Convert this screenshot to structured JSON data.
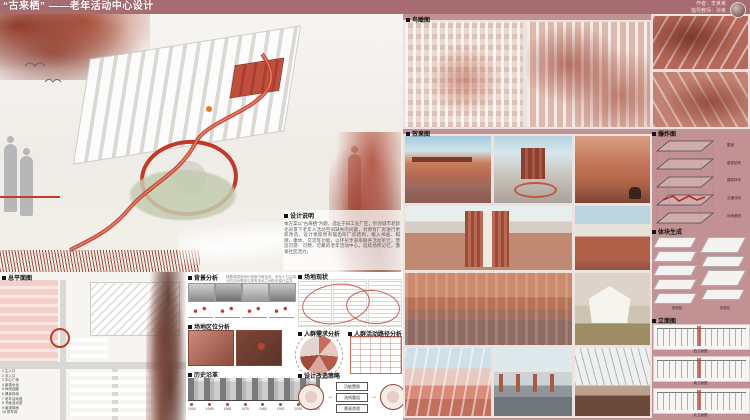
{
  "banner": {
    "title": "“古来栖” ——老年活动中心设计",
    "credits": {
      "author": "作者：李某某",
      "advisor": "指导教师：孙某"
    }
  },
  "design_note": {
    "heading": "设计说明",
    "body": "本方案以“古来栖”为题，选址于旧工业厂区，针对城市老龄化背景下老年人活动空间缺失的问题，对原有厂房进行更新改造。设计保留原有锯齿形厂房结构，植入书画、棋牌、康体、交流等功能，以环形步道串联各活动单元，营造可游、可憩、可聚的老年活动中心，延续场所记忆，激发社区活力。"
  },
  "site_plan": {
    "label": "总平面图",
    "legend": [
      "1 主入口",
      "2 次入口",
      "3 中心广场",
      "4 景观水池",
      "5 休闲连廊",
      "6 健身场地",
      "7 老年活动馆",
      "8 书画活动室",
      "9 景观绿地",
      "10 停车场"
    ]
  },
  "analysis": {
    "background": {
      "label": "背景分析",
      "note": "随着我国老龄化程度不断加深，老年人日益增长的活动需求与现有场地之间的矛盾日益突出。"
    },
    "location": {
      "label": "场地区位分析"
    },
    "history": {
      "label": "历史沿革",
      "years": [
        "1950",
        "1958",
        "1966",
        "1978",
        "1985",
        "1992",
        "2008",
        "2020"
      ]
    },
    "status": {
      "label": "场地现状"
    },
    "needs": {
      "label": "人群需求分析"
    },
    "paths": {
      "label": "人群活动路径分析"
    },
    "strategy": {
      "label": "设计改造策略",
      "steps": [
        "功能置换",
        "流线重组",
        "景观渗透"
      ]
    }
  },
  "right_panel": {
    "birdseye_label": "鸟瞰图",
    "renders_label": "效果图"
  },
  "far_right": {
    "exploded_label": "爆炸图",
    "exploded_layers": [
      "屋面",
      "屋架结构",
      "建筑体块",
      "交通流线",
      "场地基底"
    ],
    "massing_label": "体块生成",
    "massing_captions": [
      "改造前",
      "改造后"
    ],
    "elevations_label": "立面图",
    "elevation_captions": [
      "西立面图",
      "南立面图",
      "北立面图"
    ]
  },
  "colors": {
    "banner": "#a76c72",
    "panel_pink": "#c29193",
    "accent_red": "#c23b2a",
    "plan_pink": "#f2cfc9",
    "foliage": "#7e3b2c"
  }
}
